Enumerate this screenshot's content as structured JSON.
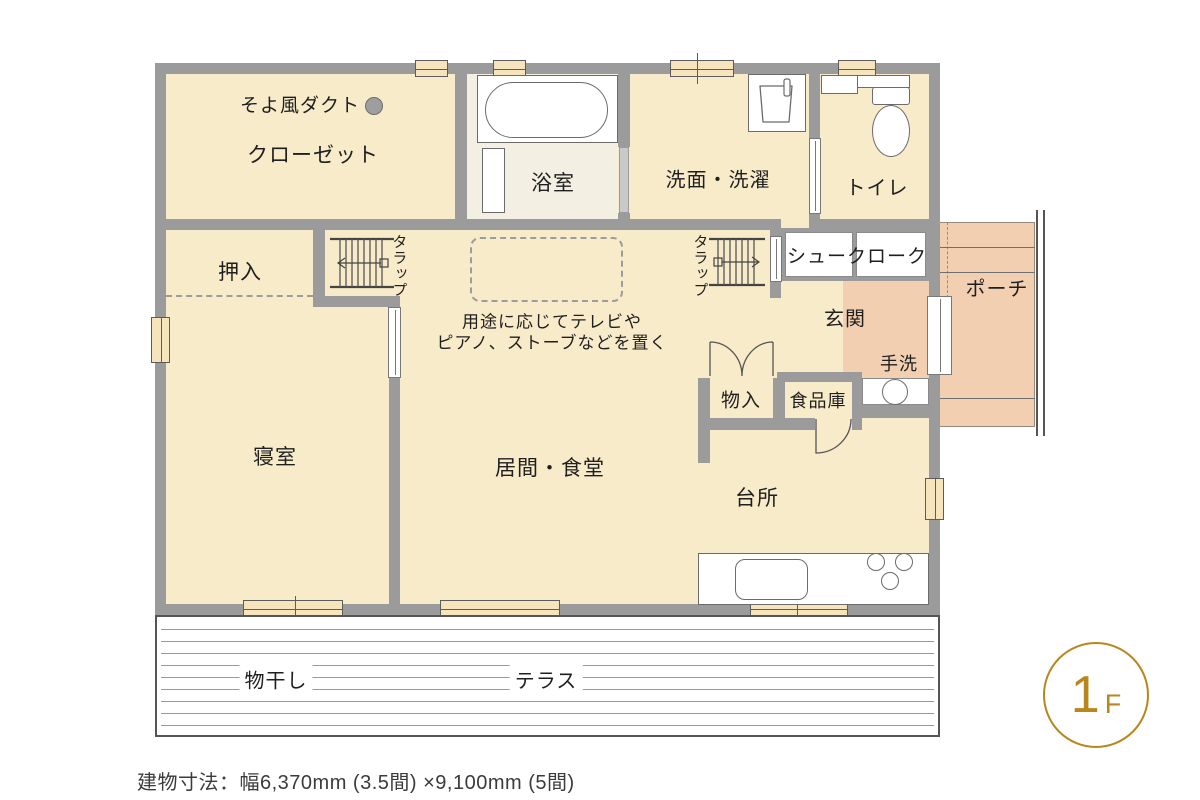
{
  "palette": {
    "floor": "#F8EBC9",
    "bath_floor": "#F4EFE3",
    "salmon": "#F3CFB2",
    "wall": "#9B9B9B",
    "window_fill": "#F6E4BD",
    "accent": "#B9861D",
    "text": "#1F1F1F"
  },
  "plan": {
    "rooms": {
      "duct": "そよ風ダクト",
      "closet": "クローゼット",
      "bath": "浴室",
      "washroom": "洗面・洗濯",
      "toilet": "トイレ",
      "oshiire": "押入",
      "ladder1": "タラップ",
      "ladder2": "タラップ",
      "shoe_cloak": "シュークローク",
      "porch": "ポーチ",
      "entrance": "玄関",
      "handwash": "手洗",
      "storage": "物入",
      "pantry": "食品庫",
      "bedroom": "寝室",
      "living_dining": "居間・食堂",
      "kitchen": "台所",
      "drying": "物干し",
      "terrace": "テラス"
    },
    "note": {
      "line1": "用途に応じてテレビや",
      "line2": "ピアノ、ストーブなどを置く"
    }
  },
  "floor_badge": {
    "number": "1",
    "suffix": "F"
  },
  "caption": "建物寸法：幅6,370mm (3.5間) ×9,100mm (5間)"
}
